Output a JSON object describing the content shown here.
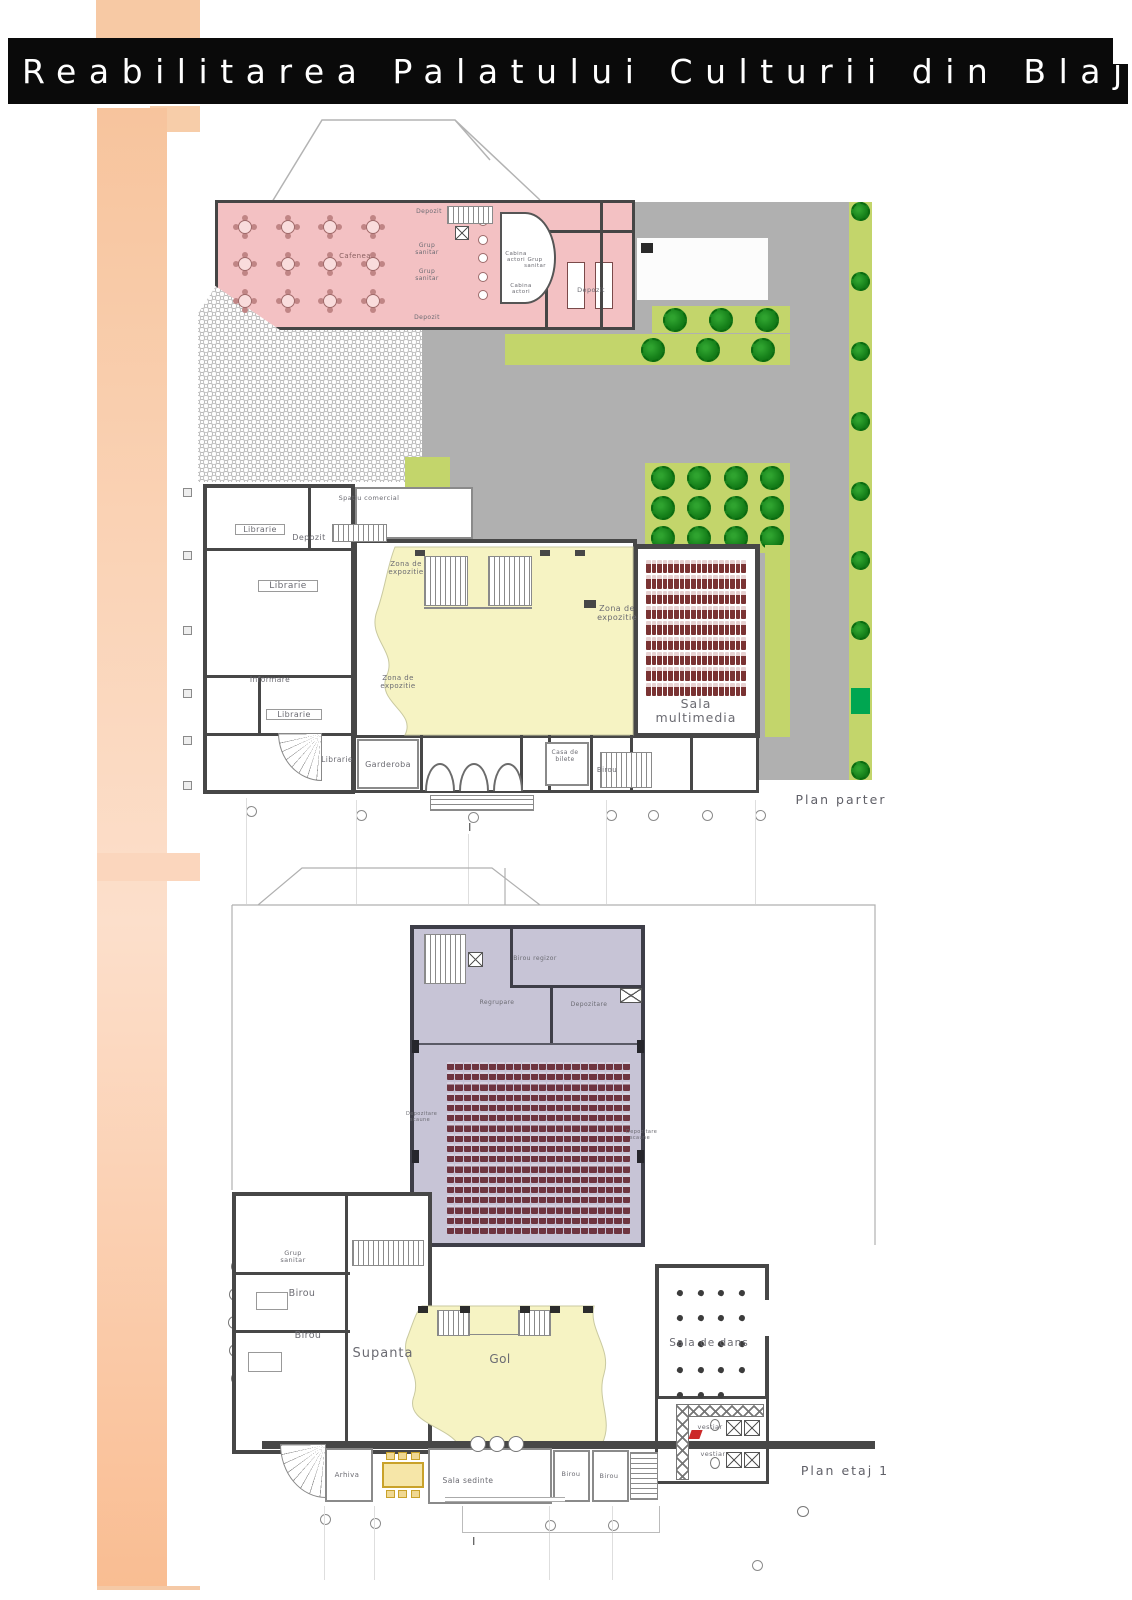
{
  "title_bar": {
    "title": "Reabilitarea Palatului Culturii din Blaj"
  },
  "colors": {
    "accent_peach": "#f8c5a0",
    "title_bar_bg": "#0a0a0a",
    "title_text": "#ffffff",
    "cafenea_pink": "#f3c1c3",
    "paving_gray": "#b0b0b0",
    "lawn_green": "#c3d56b",
    "tree_green": "#15801a",
    "bright_green": "#00a651",
    "exhibit_yellow": "#f6f3c3",
    "hall_purple": "#c7c4d6",
    "seat_maroon": "#7a3333",
    "wall_dark": "#474747"
  },
  "plan_parter": {
    "caption": "Plan parter",
    "axis_label": "I",
    "labels": {
      "cafenea": "Cafenea",
      "depozit_top": "Depozit",
      "grup_sanitar_1": "Grup sanitar",
      "grup_sanitar_2": "Grup sanitar",
      "depozit_mid": "Depozit",
      "cabina_actori_1": "Cabina actori",
      "cabina_actori_2": "Cabina actori",
      "grup_sanitar_3": "Grup sanitar",
      "depozit_dreapta": "Depozit",
      "spatiu_comercial": "Spatiu comercial",
      "librarie_1": "Librarie",
      "depozit_2": "Depozit",
      "librarie_2": "Librarie",
      "informare": "Informare",
      "librarie_3": "Librarie",
      "librarie_4": "Librarie",
      "garderoba": "Garderoba",
      "zona_expozitie_1": "Zona de expozitie",
      "zona_expozitie_2": "Zona de expozitie",
      "zona_expozitie_3": "Zona de expozitie",
      "sala_multimedia": "Sala multimedia",
      "casa_de_bilete": "Casa de bilete",
      "birou": "Birou"
    },
    "counts": {
      "cafenea_tables": 12,
      "bar_stools": 5,
      "multimedia_seats": 162,
      "multimedia_seat_rows": 9,
      "multimedia_seat_columns": 18,
      "trees_strip_top": 3,
      "trees_strip_mid": 3,
      "trees_block": 12,
      "trees_right_column": 9
    }
  },
  "plan_etaj": {
    "caption": "Plan etaj 1",
    "axis_label": "I",
    "labels": {
      "birou_regizor": "Birou regizor",
      "regrupare": "Regrupare",
      "depozitare": "Depozitare",
      "depozitare_scaune_stanga": "Depozitare scaune",
      "depozitare_scaune_dreapta": "Depozitare scaune",
      "grup_sanitar": "Grup sanitar",
      "birou_1": "Birou",
      "birou_2": "Birou",
      "supanta": "Supanta",
      "gol": "Gol",
      "sala_de_dans": "Sala de dans",
      "vestiar_1": "vestiar",
      "vestiar_2": "vestiar",
      "arhiva": "Arhiva",
      "sala_sedinte": "Sala sedinte",
      "birou_3": "Birou",
      "birou_4": "Birou"
    },
    "counts": {
      "hall_seats": 374,
      "hall_seat_rows": 17,
      "hall_seat_columns": 22,
      "dans_chairs": 19,
      "meeting_chairs": 6
    }
  }
}
